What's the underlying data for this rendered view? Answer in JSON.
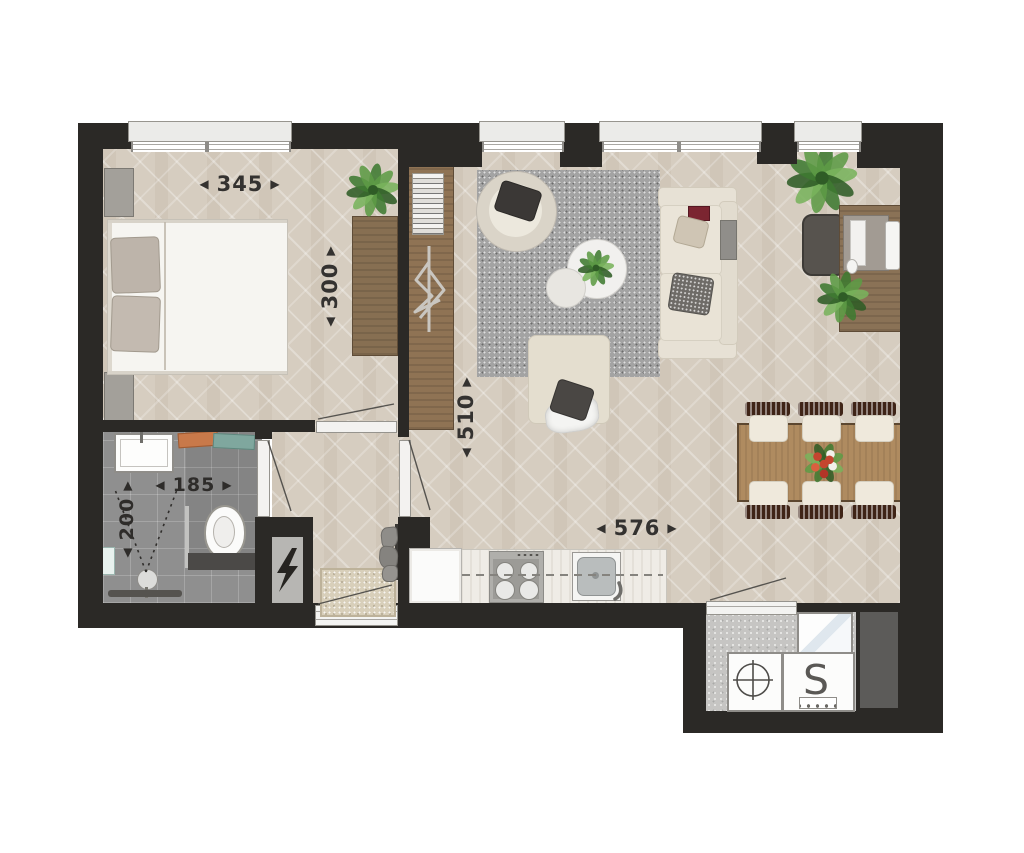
{
  "floorplan": {
    "dimensions": {
      "bedroom_width": "345",
      "bedroom_depth": "300",
      "living_depth": "510",
      "living_width": "576",
      "bathroom_width": "185",
      "bathroom_depth": "200"
    },
    "glyphs": {
      "arrow_left": "◀",
      "arrow_right": "▶",
      "washer_symbol": "S"
    },
    "colors": {
      "wall": "#2b2926",
      "wood_floor": "#d6cdc0",
      "bathroom_tile": "#8f8f8f",
      "rug": "#a3a3a3",
      "furniture_wood": "#af8b60",
      "upholstery": "#e7e1d5",
      "plant_green": "#4e8f3a",
      "flower_red": "#c4452f"
    }
  }
}
